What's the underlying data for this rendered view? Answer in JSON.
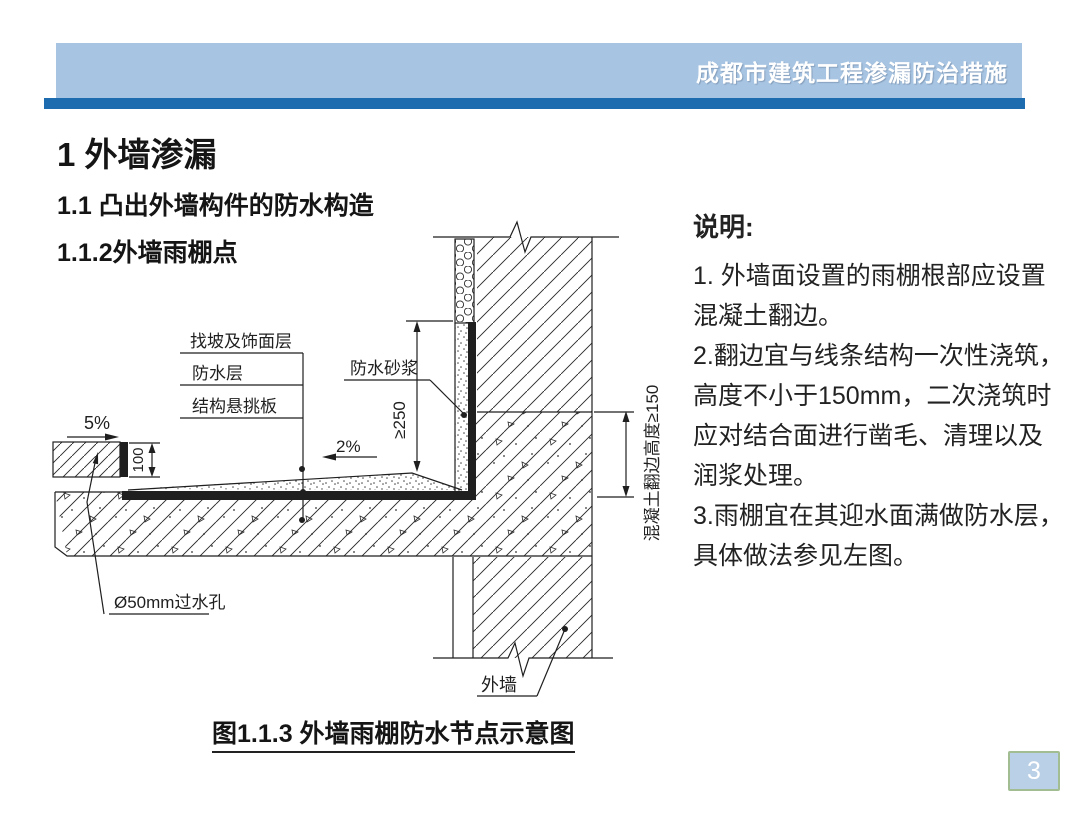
{
  "header": {
    "title": "成都市建筑工程渗漏防治措施"
  },
  "headings": {
    "h1": "1 外墙渗漏",
    "h2": "1.1 凸出外墙构件的防水构造",
    "h3": "1.1.2外墙雨棚点"
  },
  "notes": {
    "title": "说明:",
    "lines": [
      "1. 外墙面设置的雨棚根部应设置",
      "混凝土翻边。",
      "2.翻边宜与线条结构一次性浇筑，",
      "高度不小于150mm，二次浇筑时",
      "应对结合面进行凿毛、清理以及",
      "润浆处理。",
      "3.雨棚宜在其迎水面满做防水层，",
      "具体做法参见左图。"
    ]
  },
  "diagram": {
    "labels": {
      "screed_finish": "找坡及饰面层",
      "waterproof_layer": "防水层",
      "cantilever_slab": "结构悬挑板",
      "waterproof_mortar": "防水砂浆",
      "drain_hole": "Ø50mm过水孔",
      "exterior_wall": "外墙",
      "dim_250": "≥250",
      "dim_100": "100",
      "dim_upstand": "混凝土翻边高度≥150",
      "slope_5": "5%",
      "slope_2": "2%"
    },
    "caption": "图1.1.3 外墙雨棚防水节点示意图"
  },
  "footer": {
    "page_number": "3"
  },
  "colors": {
    "header_bar": "#a7c5e3",
    "header_stripe": "#1e6cb0",
    "header_text": "#ffffff",
    "page_badge_bg": "#bad0e6",
    "page_badge_border": "#a3bd92",
    "line_color": "#1f1f1f"
  }
}
